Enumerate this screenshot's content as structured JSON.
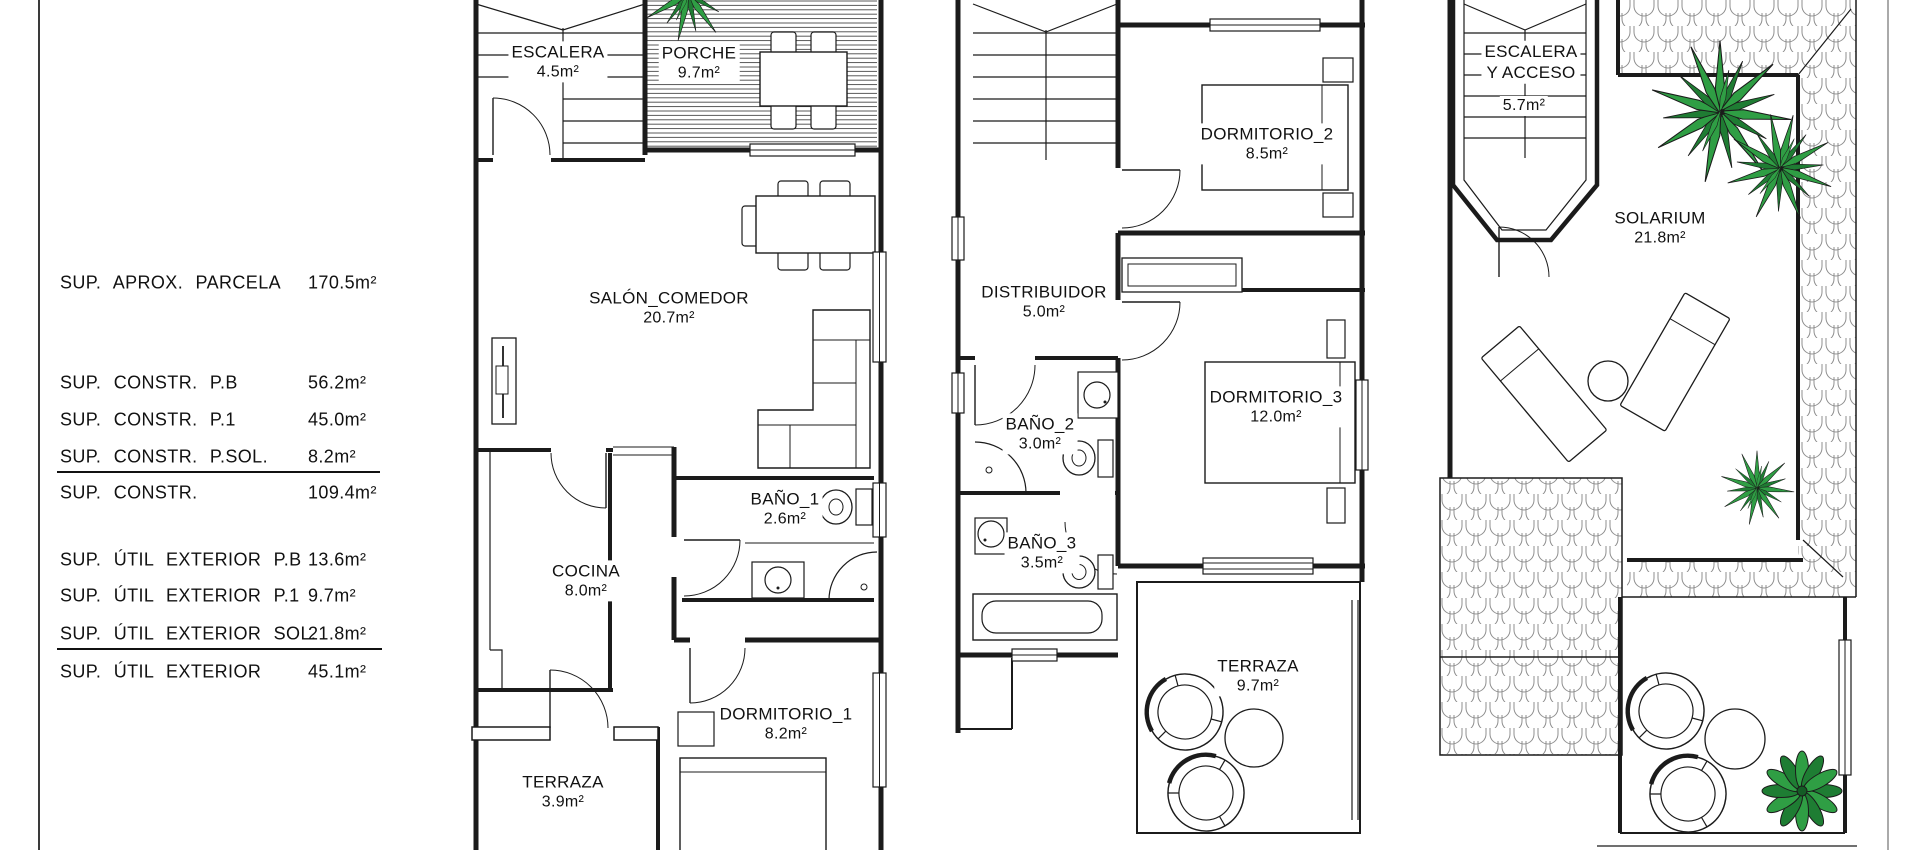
{
  "page": {
    "background": "#ffffff",
    "border_color": "#3a3a3a"
  },
  "summary": {
    "rows": [
      {
        "label": "SUP. APROX. PARCELA",
        "value": "170.5m²"
      },
      {
        "label": "SUP. CONSTR. P.B",
        "value": "56.2m²"
      },
      {
        "label": "SUP. CONSTR. P.1",
        "value": "45.0m²"
      },
      {
        "label": "SUP. CONSTR. P.SOL.",
        "value": "8.2m²"
      },
      {
        "label": "SUP. CONSTR.",
        "value": "109.4m²"
      },
      {
        "label": "SUP. ÚTIL EXTERIOR P.B",
        "value": "13.6m²"
      },
      {
        "label": "SUP. ÚTIL EXTERIOR P.1",
        "value": "9.7m²"
      },
      {
        "label": "SUP. ÚTIL EXTERIOR SOL.",
        "value": "21.8m²"
      },
      {
        "label": "SUP. ÚTIL EXTERIOR",
        "value": "45.1m²"
      }
    ]
  },
  "floors": {
    "ground": {
      "rooms": [
        {
          "name": "ESCALERA",
          "area": "4.5m²"
        },
        {
          "name": "PORCHE",
          "area": "9.7m²"
        },
        {
          "name": "SALÓN_COMEDOR",
          "area": "20.7m²"
        },
        {
          "name": "COCINA",
          "area": "8.0m²"
        },
        {
          "name": "BAÑO_1",
          "area": "2.6m²"
        },
        {
          "name": "DORMITORIO_1",
          "area": "8.2m²"
        },
        {
          "name": "TERRAZA",
          "area": "3.9m²"
        }
      ]
    },
    "first": {
      "rooms": [
        {
          "name": "DORMITORIO_2",
          "area": "8.5m²"
        },
        {
          "name": "DISTRIBUIDOR",
          "area": "5.0m²"
        },
        {
          "name": "BAÑO_2",
          "area": "3.0m²"
        },
        {
          "name": "DORMITORIO_3",
          "area": "12.0m²"
        },
        {
          "name": "BAÑO_3",
          "area": "3.5m²"
        },
        {
          "name": "TERRAZA",
          "area": "9.7m²"
        }
      ]
    },
    "solarium": {
      "rooms": [
        {
          "name": "ESCALERA",
          "name2": "Y ACCESO",
          "area": "5.7m²"
        },
        {
          "name": "SOLARIUM",
          "area": "21.8m²"
        }
      ]
    }
  },
  "colors": {
    "line": "#1b1b1b",
    "hatch": "#8f8f8f",
    "palm_green": "#2f9e44",
    "palm_green_dark": "#1f7c33",
    "plant_green": "#1e7d33"
  }
}
